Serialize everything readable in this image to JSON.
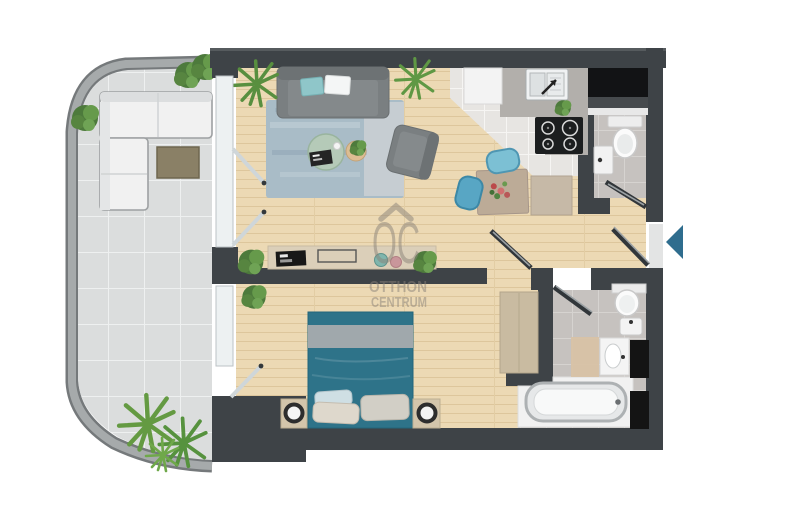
{
  "image": {
    "type": "apartment-floor-plan-render",
    "background": "#ffffff"
  },
  "watermark": {
    "logo_text": "OC",
    "brand_line1": "OTTHON",
    "brand_line2": "CENTRUM",
    "color": "#8a8279"
  },
  "indicators": {
    "entrance_arrow": {
      "icon": "left-triangle",
      "color": "#2f6d8e"
    }
  },
  "palette": {
    "wall": "#3e4347",
    "wood_floor": "#ecd9b4",
    "kitchen_tile": "#e7e5e2",
    "bath_tile": "#c6c2bf",
    "terrace_tile": "#dbdddd",
    "rug_blue": "#a9bcc7",
    "bed_teal": "#2e7389",
    "chair_teal": "#7cc0d4",
    "appliance_black": "#141414"
  }
}
